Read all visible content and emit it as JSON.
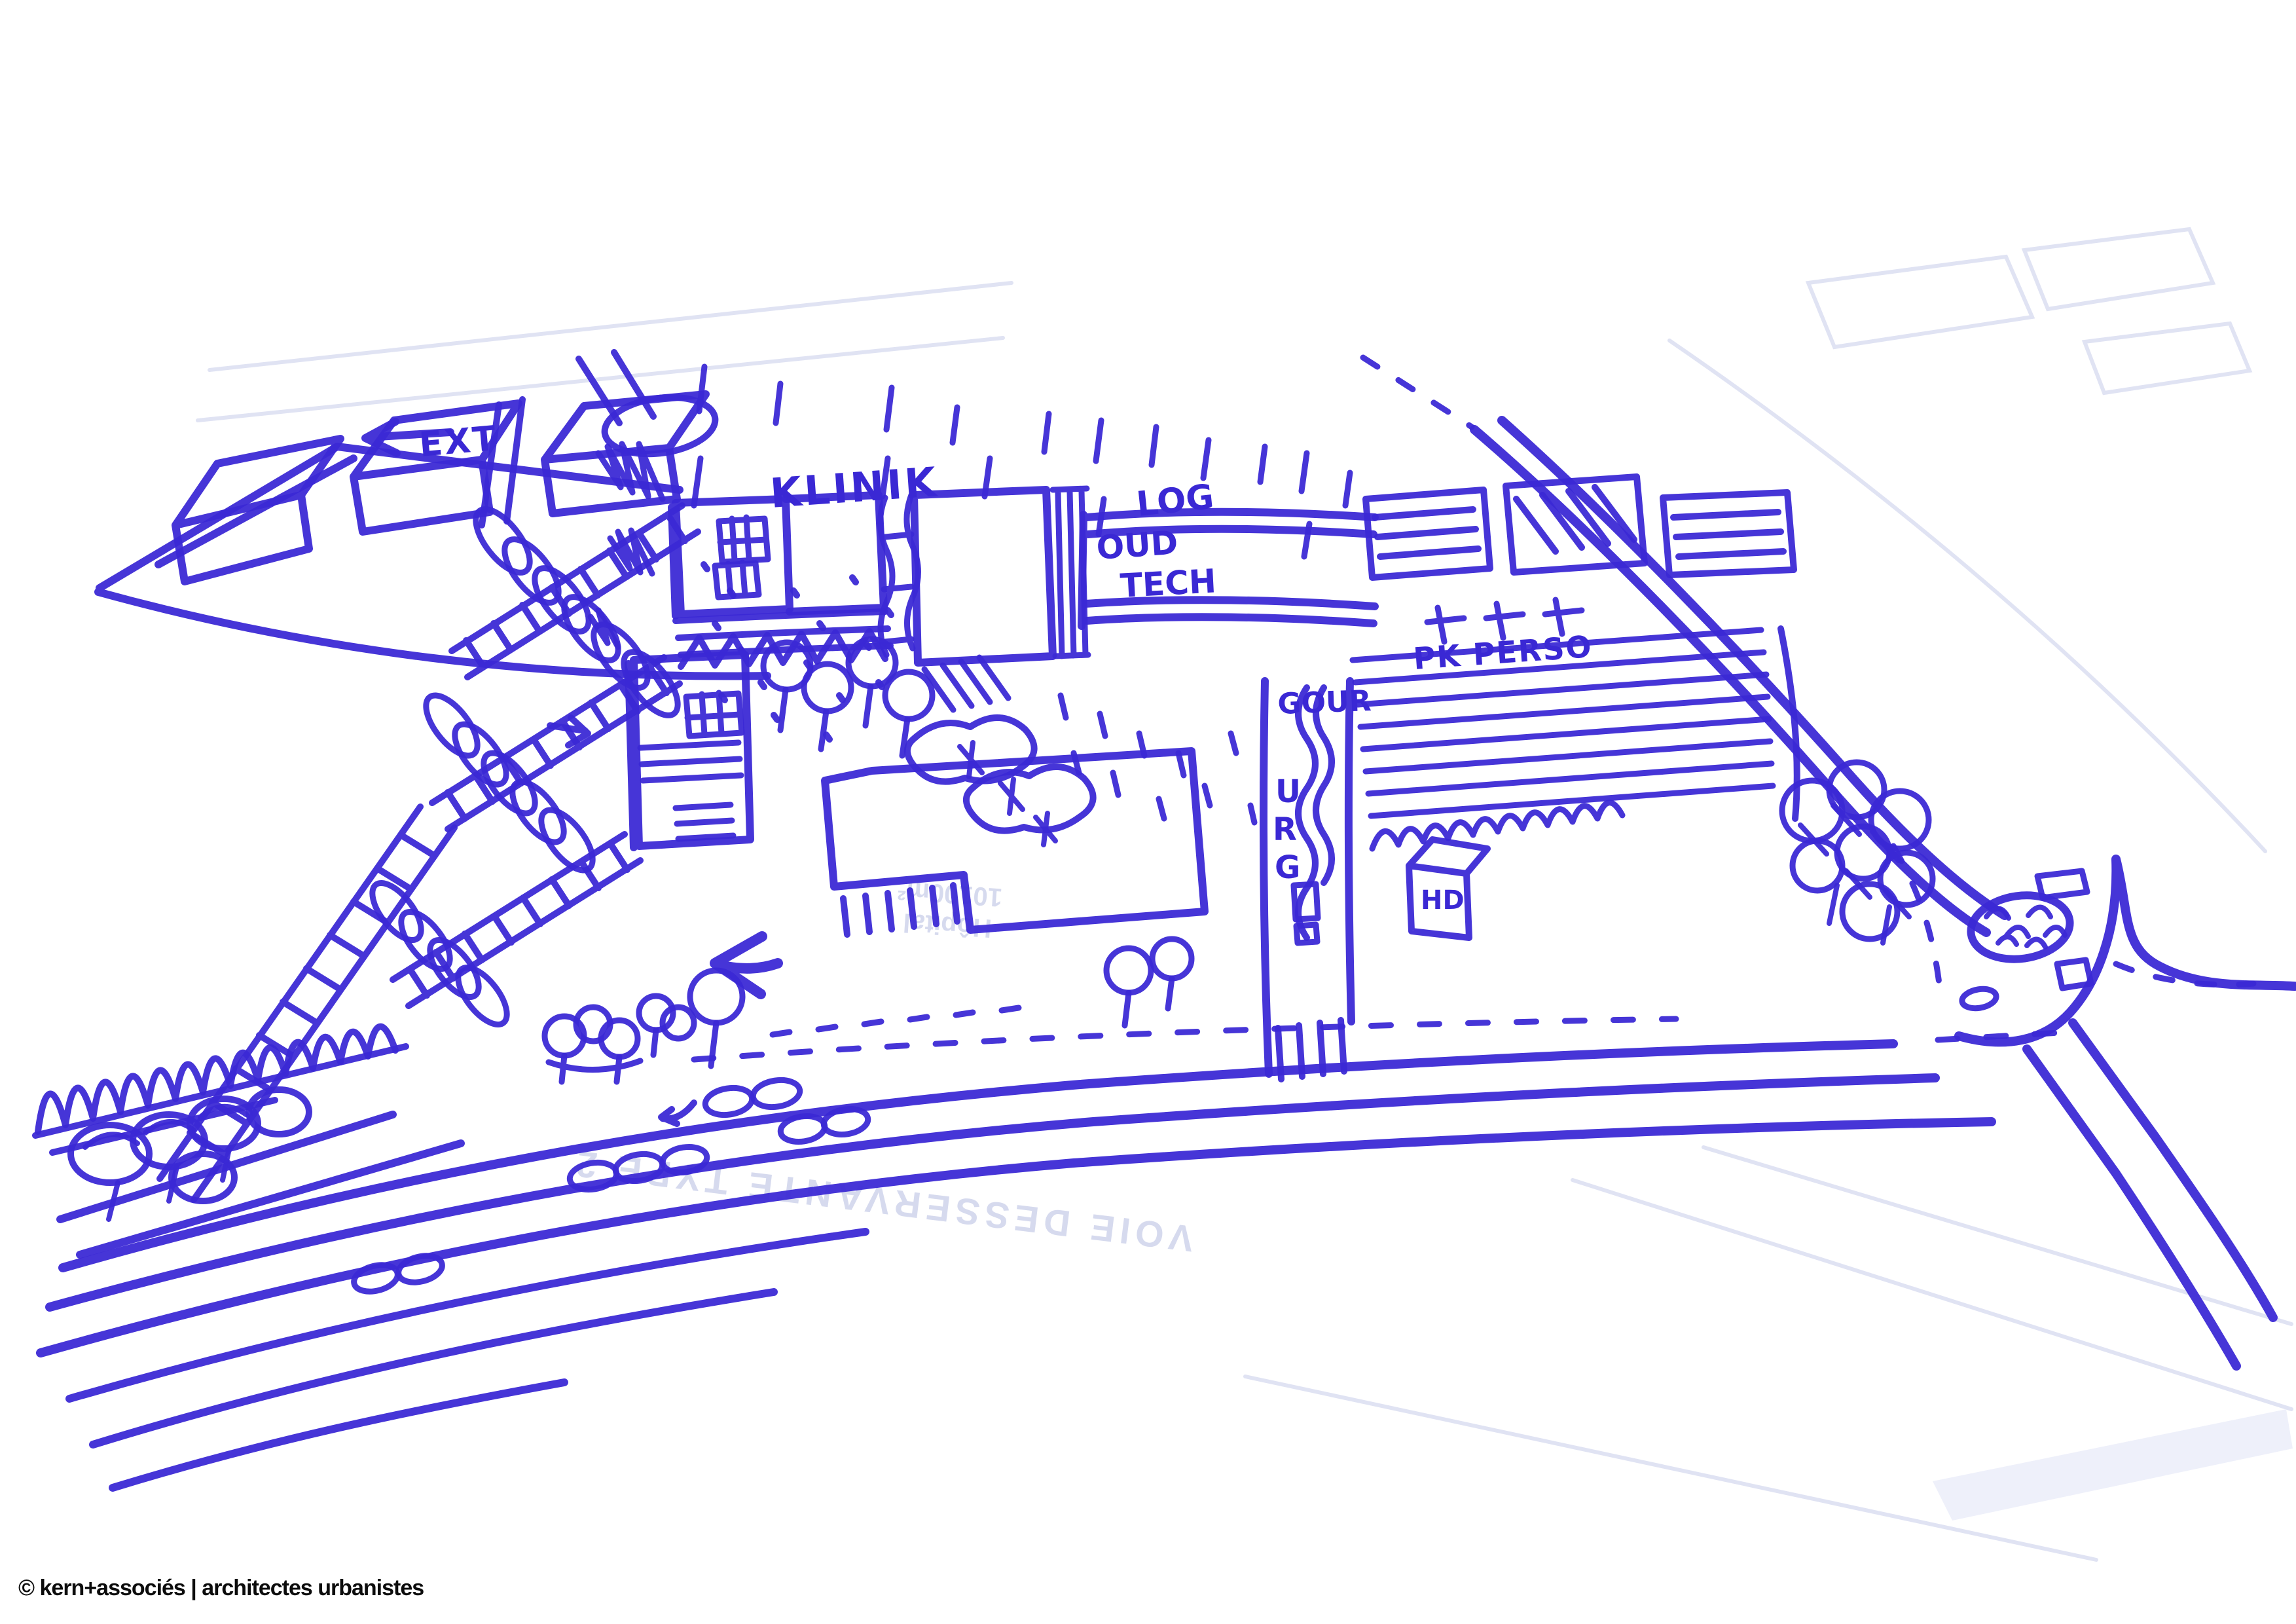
{
  "palette": {
    "ink": "#3a28d4",
    "paper": "#ffffff",
    "underlay": "#e0e3f3",
    "ghost": "#c9cee9",
    "footer": "#0c0c0c"
  },
  "annotations": {
    "ext": "EXT",
    "klinik": "KLINIK",
    "log": {
      "line1": "LOG",
      "line2": "OUD",
      "line3": "TECH"
    },
    "gour": "GOUR",
    "urg": {
      "u": "U",
      "r": "R",
      "g": "G"
    },
    "hd": "HD",
    "pk_perso": "PK PERSO"
  },
  "underlay_text": {
    "hopital": "Hôpital",
    "area": "10100m²",
    "road": "VOIE DESSERVANTE TYPE 2"
  },
  "footer": {
    "credit": "© kern+associés | architectes urbanistes"
  }
}
